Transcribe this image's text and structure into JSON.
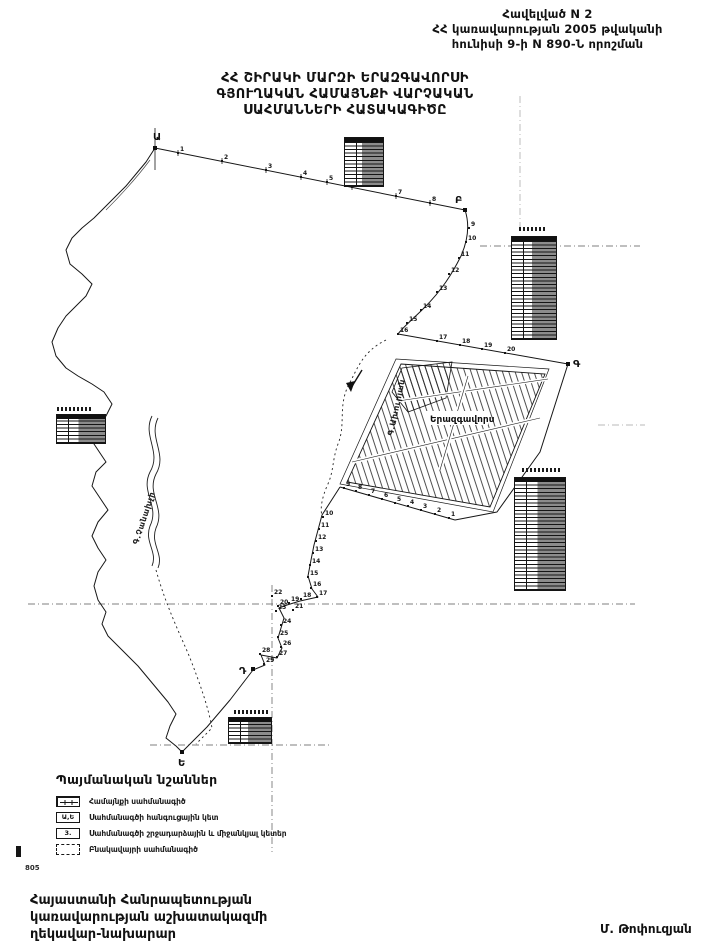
{
  "header": {
    "line1": "Հավելված N 2",
    "line2": "ՀՀ կառավարության 2005 թվականի",
    "line3": "հունիսի 9-ի N 890-Ն որոշման"
  },
  "title": {
    "line1": "ՀՀ ՇԻՐԱԿԻ ՄԱՐԶԻ ԵՐԱԶԳԱՎՈՐՍԻ",
    "line2": "ԳՅՈՒՂԱԿԱՆ ՀԱՄԱՅՆՔԻ ՎԱՐՉԱԿԱՆ",
    "line3": "ՍԱՀՄԱՆՆԵՐԻ ՀԱՏԱԿԱԳԻԾԸ"
  },
  "map": {
    "settlement_label": "Երազգավորս",
    "river_label_left": "Գ.Չանախչի",
    "river_label_center": "Գ.Ախուրյան",
    "junctions": [
      {
        "label": "Ա",
        "x": 155,
        "y": 148,
        "lx": -2,
        "ly": -8
      },
      {
        "label": "Բ",
        "x": 465,
        "y": 210,
        "lx": -10,
        "ly": -7
      },
      {
        "label": "Գ",
        "x": 568,
        "y": 364,
        "lx": 5,
        "ly": 3
      },
      {
        "label": "Դ",
        "x": 253,
        "y": 669,
        "lx": -14,
        "ly": 5
      },
      {
        "label": "Ե",
        "x": 182,
        "y": 752,
        "lx": -4,
        "ly": 14
      }
    ],
    "point_series": [
      {
        "name": "outer-boundary",
        "points": [
          [
            1,
            178,
            153
          ],
          [
            2,
            222,
            161
          ],
          [
            3,
            266,
            170
          ],
          [
            4,
            301,
            177
          ],
          [
            5,
            327,
            182
          ],
          [
            6,
            352,
            187
          ],
          [
            7,
            396,
            196
          ],
          [
            8,
            430,
            203
          ],
          [
            9,
            469,
            228
          ],
          [
            10,
            466,
            242
          ],
          [
            11,
            459,
            258
          ],
          [
            12,
            449,
            274
          ],
          [
            13,
            437,
            292
          ],
          [
            14,
            421,
            310
          ],
          [
            15,
            407,
            323
          ],
          [
            16,
            398,
            334
          ],
          [
            17,
            437,
            341
          ],
          [
            18,
            460,
            345
          ],
          [
            19,
            482,
            349
          ],
          [
            20,
            505,
            353
          ]
        ]
      },
      {
        "name": "settlement-boundary",
        "points": [
          [
            1,
            449,
            518
          ],
          [
            2,
            435,
            514
          ],
          [
            3,
            421,
            510
          ],
          [
            4,
            408,
            506
          ],
          [
            5,
            395,
            503
          ],
          [
            6,
            382,
            499
          ],
          [
            7,
            369,
            495
          ],
          [
            8,
            356,
            491
          ],
          [
            9,
            344,
            488
          ],
          [
            10,
            323,
            517
          ],
          [
            11,
            319,
            529
          ],
          [
            12,
            316,
            541
          ],
          [
            13,
            313,
            553
          ],
          [
            14,
            310,
            565
          ],
          [
            15,
            308,
            577
          ],
          [
            16,
            311,
            588
          ],
          [
            17,
            317,
            597
          ],
          [
            18,
            301,
            599
          ],
          [
            19,
            289,
            603
          ],
          [
            20,
            278,
            606
          ],
          [
            21,
            293,
            610
          ],
          [
            22,
            272,
            596
          ],
          [
            23,
            276,
            611
          ],
          [
            24,
            281,
            625
          ],
          [
            25,
            278,
            637
          ],
          [
            26,
            281,
            647
          ],
          [
            27,
            277,
            657
          ],
          [
            28,
            260,
            654
          ],
          [
            29,
            264,
            664
          ]
        ]
      }
    ]
  },
  "legend": {
    "heading": "Պայմանական նշաններ",
    "items": [
      {
        "label": "Համայնքի սահմանագիծ"
      },
      {
        "label": "Սահմանագծի հանգուցային կետ",
        "icon_text": "Ա,Ե"
      },
      {
        "label": "Սահմանագծի շրջադարձային և միջանկյալ կետեր",
        "icon_text": "3."
      },
      {
        "label": "Բնակավայրի սահմանագիծ"
      }
    ]
  },
  "footer": {
    "left_line1": "Հայաստանի Հանրապետության",
    "left_line2": "կառավարության աշխատակազմի",
    "left_line3": "ղեկավար-նախարար",
    "right_signature": "Մ. Թոփուզյան"
  },
  "page_number": "805"
}
